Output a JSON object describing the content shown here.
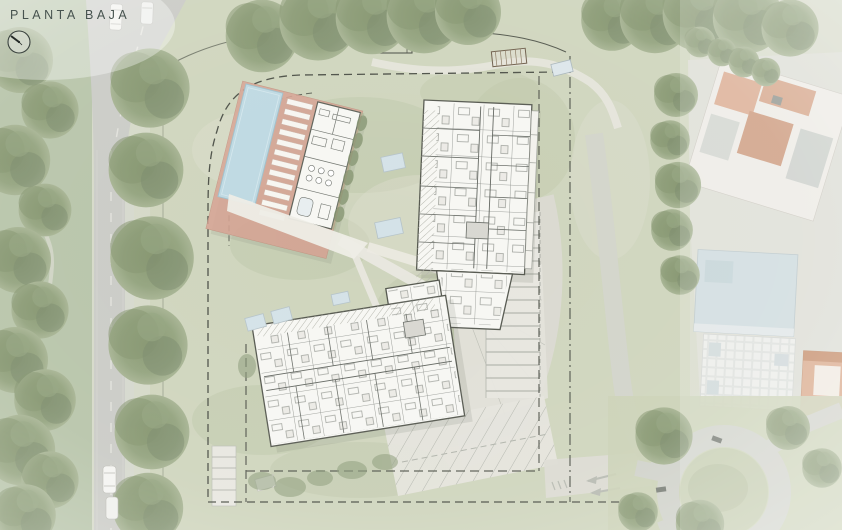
{
  "header": {
    "title": "PLANTA BAJA"
  },
  "north_indicator": {
    "icon": "north-arrow-icon"
  },
  "palette": {
    "base": "#d7dacb",
    "lawn": "#cfd5bf",
    "lawn_shade": "#b5c19e",
    "forest": "#b2bfa3",
    "tree": "#8d9c7a",
    "road": "#cacbc6",
    "path": "#e9e8e0",
    "paving": "#e4e3db",
    "pool": "#bed9e2",
    "pool_deck": "#d7a292",
    "building": "#f7f7f3",
    "plan_line": "#70746f",
    "boundary": "#4b4f46",
    "roof_terracotta": "#d3a184",
    "roof_blue": "#ccd9dc",
    "roof_white": "#ebece9",
    "title": "#47534f"
  },
  "features": [
    "swimming-pool",
    "sun-deck",
    "clubhouse",
    "residential-building-north",
    "residential-building-south",
    "skylights",
    "pergola",
    "surface-parking",
    "entrance-driveway",
    "property-boundary",
    "tree-lined-avenue",
    "existing-neighborhood-buildings",
    "roundabout"
  ]
}
